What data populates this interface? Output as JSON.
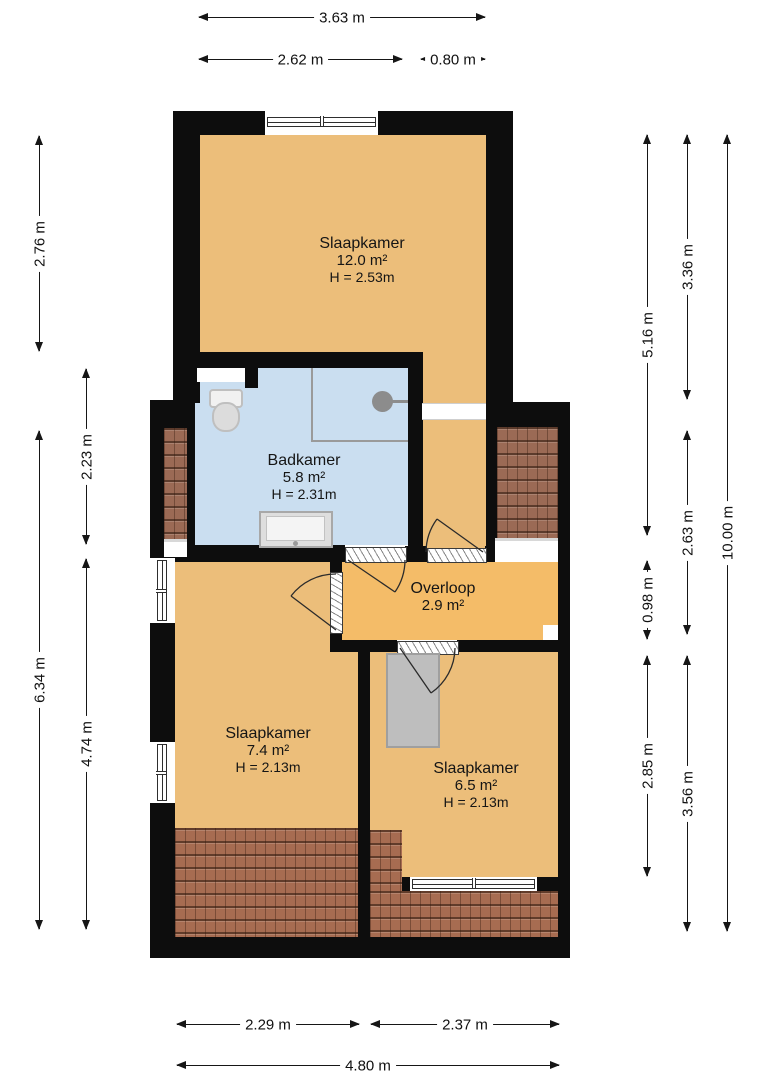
{
  "plan": {
    "type": "floor-plan",
    "rooms": [
      {
        "name": "Slaapkamer",
        "area": "12.0 m²",
        "height": "H = 2.53m"
      },
      {
        "name": "Badkamer",
        "area": "5.8 m²",
        "height": "H = 2.31m"
      },
      {
        "name": "Overloop",
        "area": "2.9 m²"
      },
      {
        "name": "Slaapkamer",
        "area": "7.4 m²",
        "height": "H = 2.13m"
      },
      {
        "name": "Slaapkamer",
        "area": "6.5 m²",
        "height": "H = 2.13m"
      }
    ],
    "dimensions": {
      "top": [
        {
          "label": "3.63 m"
        },
        {
          "label": "2.62 m"
        },
        {
          "label": "0.80 m"
        }
      ],
      "bottom": [
        {
          "label": "2.29 m"
        },
        {
          "label": "2.37 m"
        },
        {
          "label": "4.80 m"
        }
      ],
      "left": [
        {
          "label": "2.76 m"
        },
        {
          "label": "2.23 m"
        },
        {
          "label": "6.34 m"
        },
        {
          "label": "4.74 m"
        }
      ],
      "right": [
        {
          "label": "5.16 m"
        },
        {
          "label": "0.98 m"
        },
        {
          "label": "2.85 m"
        },
        {
          "label": "3.36 m"
        },
        {
          "label": "2.63 m"
        },
        {
          "label": "3.56 m"
        },
        {
          "label": "10.00 m"
        }
      ]
    },
    "symbols": [
      "toilet",
      "shower-head",
      "bathtub",
      "stairwell",
      "door-swing",
      "window",
      "roof-tiles"
    ],
    "colors": {
      "wall": "#0d0d0d",
      "room_fill": "#ecbe7a",
      "hall_fill": "#f4bc68",
      "bath_fill": "#cadef0",
      "roof_tiles": "#9b6a55",
      "roof_tiles_warm": "#a76c51",
      "stairs": "#bebebe",
      "fixture": "#8c8c8c",
      "dimension_text": "#111111"
    }
  }
}
